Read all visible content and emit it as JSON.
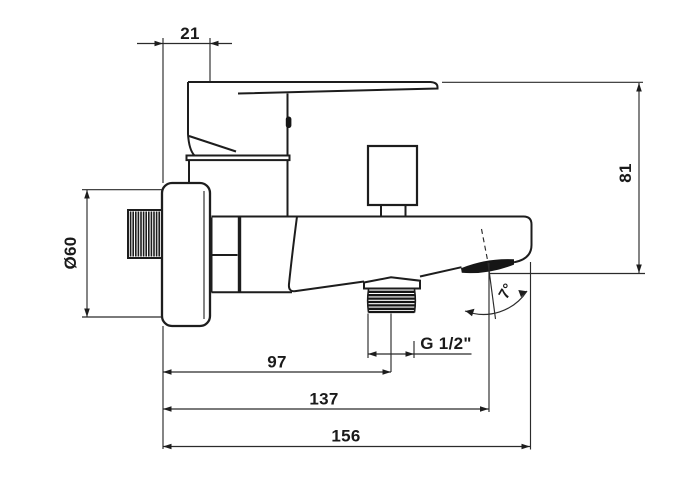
{
  "meta": {
    "drawing_type": "faucet technical dimension drawing",
    "background": "#ffffff",
    "line_color": "#1d1d1d",
    "dimension_color": "#2b2b2b"
  },
  "labels": {
    "offset_top": "21",
    "height": "81",
    "flange_diameter": "Ø60",
    "outlet_thread": "G 1/2\"",
    "depth_to_outlet_axis": "97",
    "depth_to_spout_tip": "137",
    "depth_total": "156",
    "spout_angle": "7°"
  }
}
